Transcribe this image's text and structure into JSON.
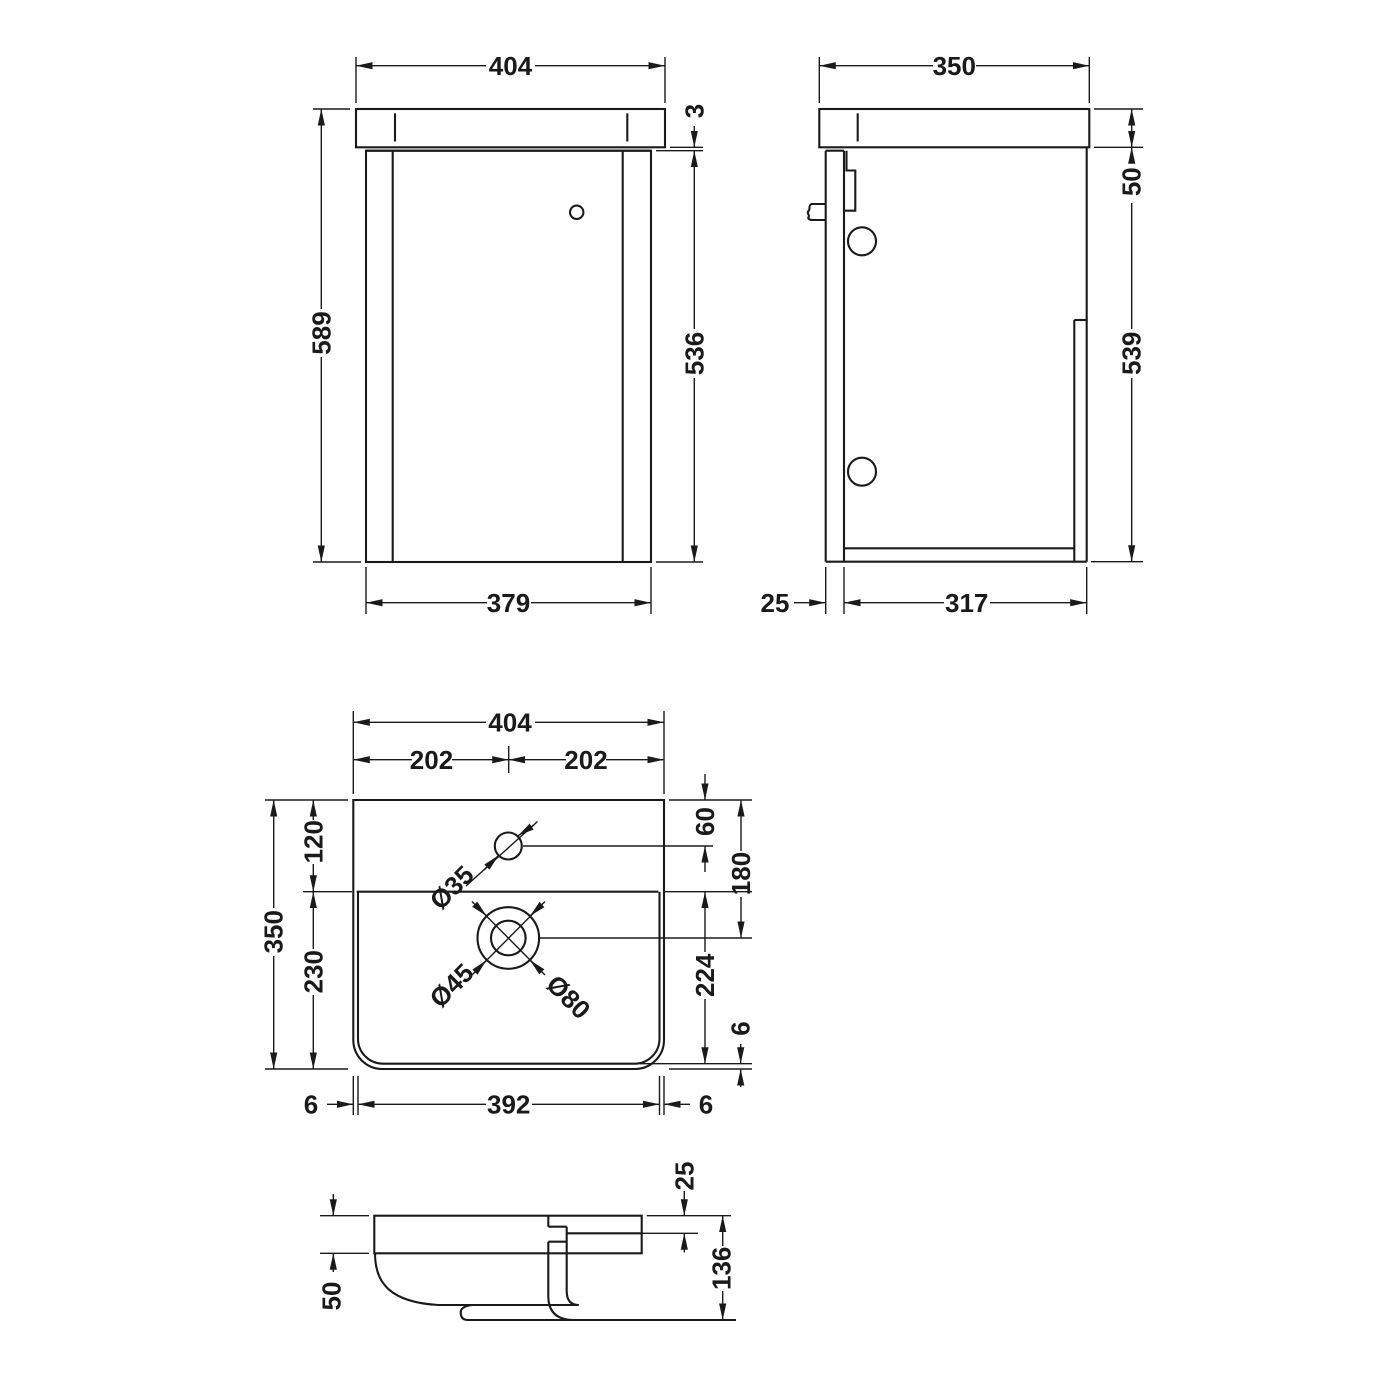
{
  "page": {
    "background": "#ffffff",
    "line_color": "#1a1a1a"
  },
  "views": {
    "front": {
      "overall_width": "404",
      "overall_height": "589",
      "worktop_reveal": "3",
      "door_height": "536",
      "carcass_width": "379"
    },
    "side": {
      "overall_depth": "350",
      "worktop_thickness": "50",
      "carcass_height": "539",
      "door_thickness": "25",
      "carcass_depth": "317"
    },
    "plan": {
      "overall_width": "404",
      "centre_left": "202",
      "centre_right": "202",
      "overall_depth": "350",
      "back_to_bowl": "120",
      "bowl_front": "230",
      "tap_centre": "60",
      "waste_centre": "180",
      "bowl_depth": "224",
      "rim_front": "6",
      "rim_left": "6",
      "bowl_width": "392",
      "rim_right": "6",
      "tap_hole": "Ø35",
      "waste_hole": "Ø45",
      "waste_flange": "Ø80"
    },
    "section": {
      "ledge": "25",
      "height": "136",
      "bowl": "50"
    }
  }
}
